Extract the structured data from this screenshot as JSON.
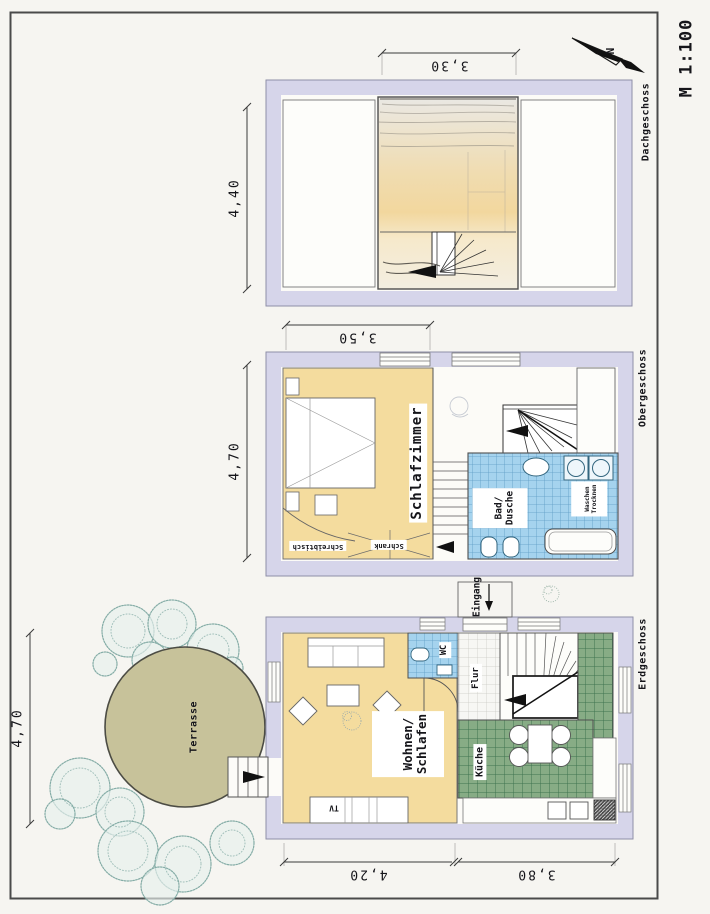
{
  "sheet": {
    "scale_label": "M 1:100",
    "north_letter": "N"
  },
  "palette": {
    "paper": "#f6f5f1",
    "wall_lavender": "#d6d5ea",
    "floor_yellow": "#f4dc9e",
    "tile_blue": "#a5d3ee",
    "tile_blue_grid": "#5e9cc4",
    "tile_green": "#87ac85",
    "tile_green_grid": "#3f7350",
    "terrace_olive": "#c7c29a",
    "tree_teal": "#84aca6",
    "attic_wash_peach": "#f2d79e",
    "line_dark": "#3a3a3a"
  },
  "dachgeschoss": {
    "label": "Dachgeschoss",
    "dim_width": "3,30",
    "dim_depth": "4,40"
  },
  "obergeschoss": {
    "label": "Obergeschoss",
    "dim_width": "3,50",
    "dim_depth": "4,70",
    "rooms": {
      "schlafzimmer": "Schlafzimmer",
      "bad_line1": "Bad/",
      "bad_line2": "Dusche",
      "waschen_line1": "Waschen",
      "waschen_line2": "Trocknen",
      "schreibtisch": "Schreibtisch",
      "schrank": "Schrank"
    }
  },
  "erdgeschoss": {
    "label": "Erdgeschoss",
    "dim_left": "4,20",
    "dim_right": "3,80",
    "dim_terrace": "4,70",
    "rooms": {
      "wohnen_line1": "Wohnen/",
      "wohnen_line2": "Schlafen",
      "kueche": "Küche",
      "flur": "Flur",
      "wc": "WC",
      "eingang": "Eingang",
      "tv": "TV",
      "terrasse": "Terrasse"
    }
  }
}
